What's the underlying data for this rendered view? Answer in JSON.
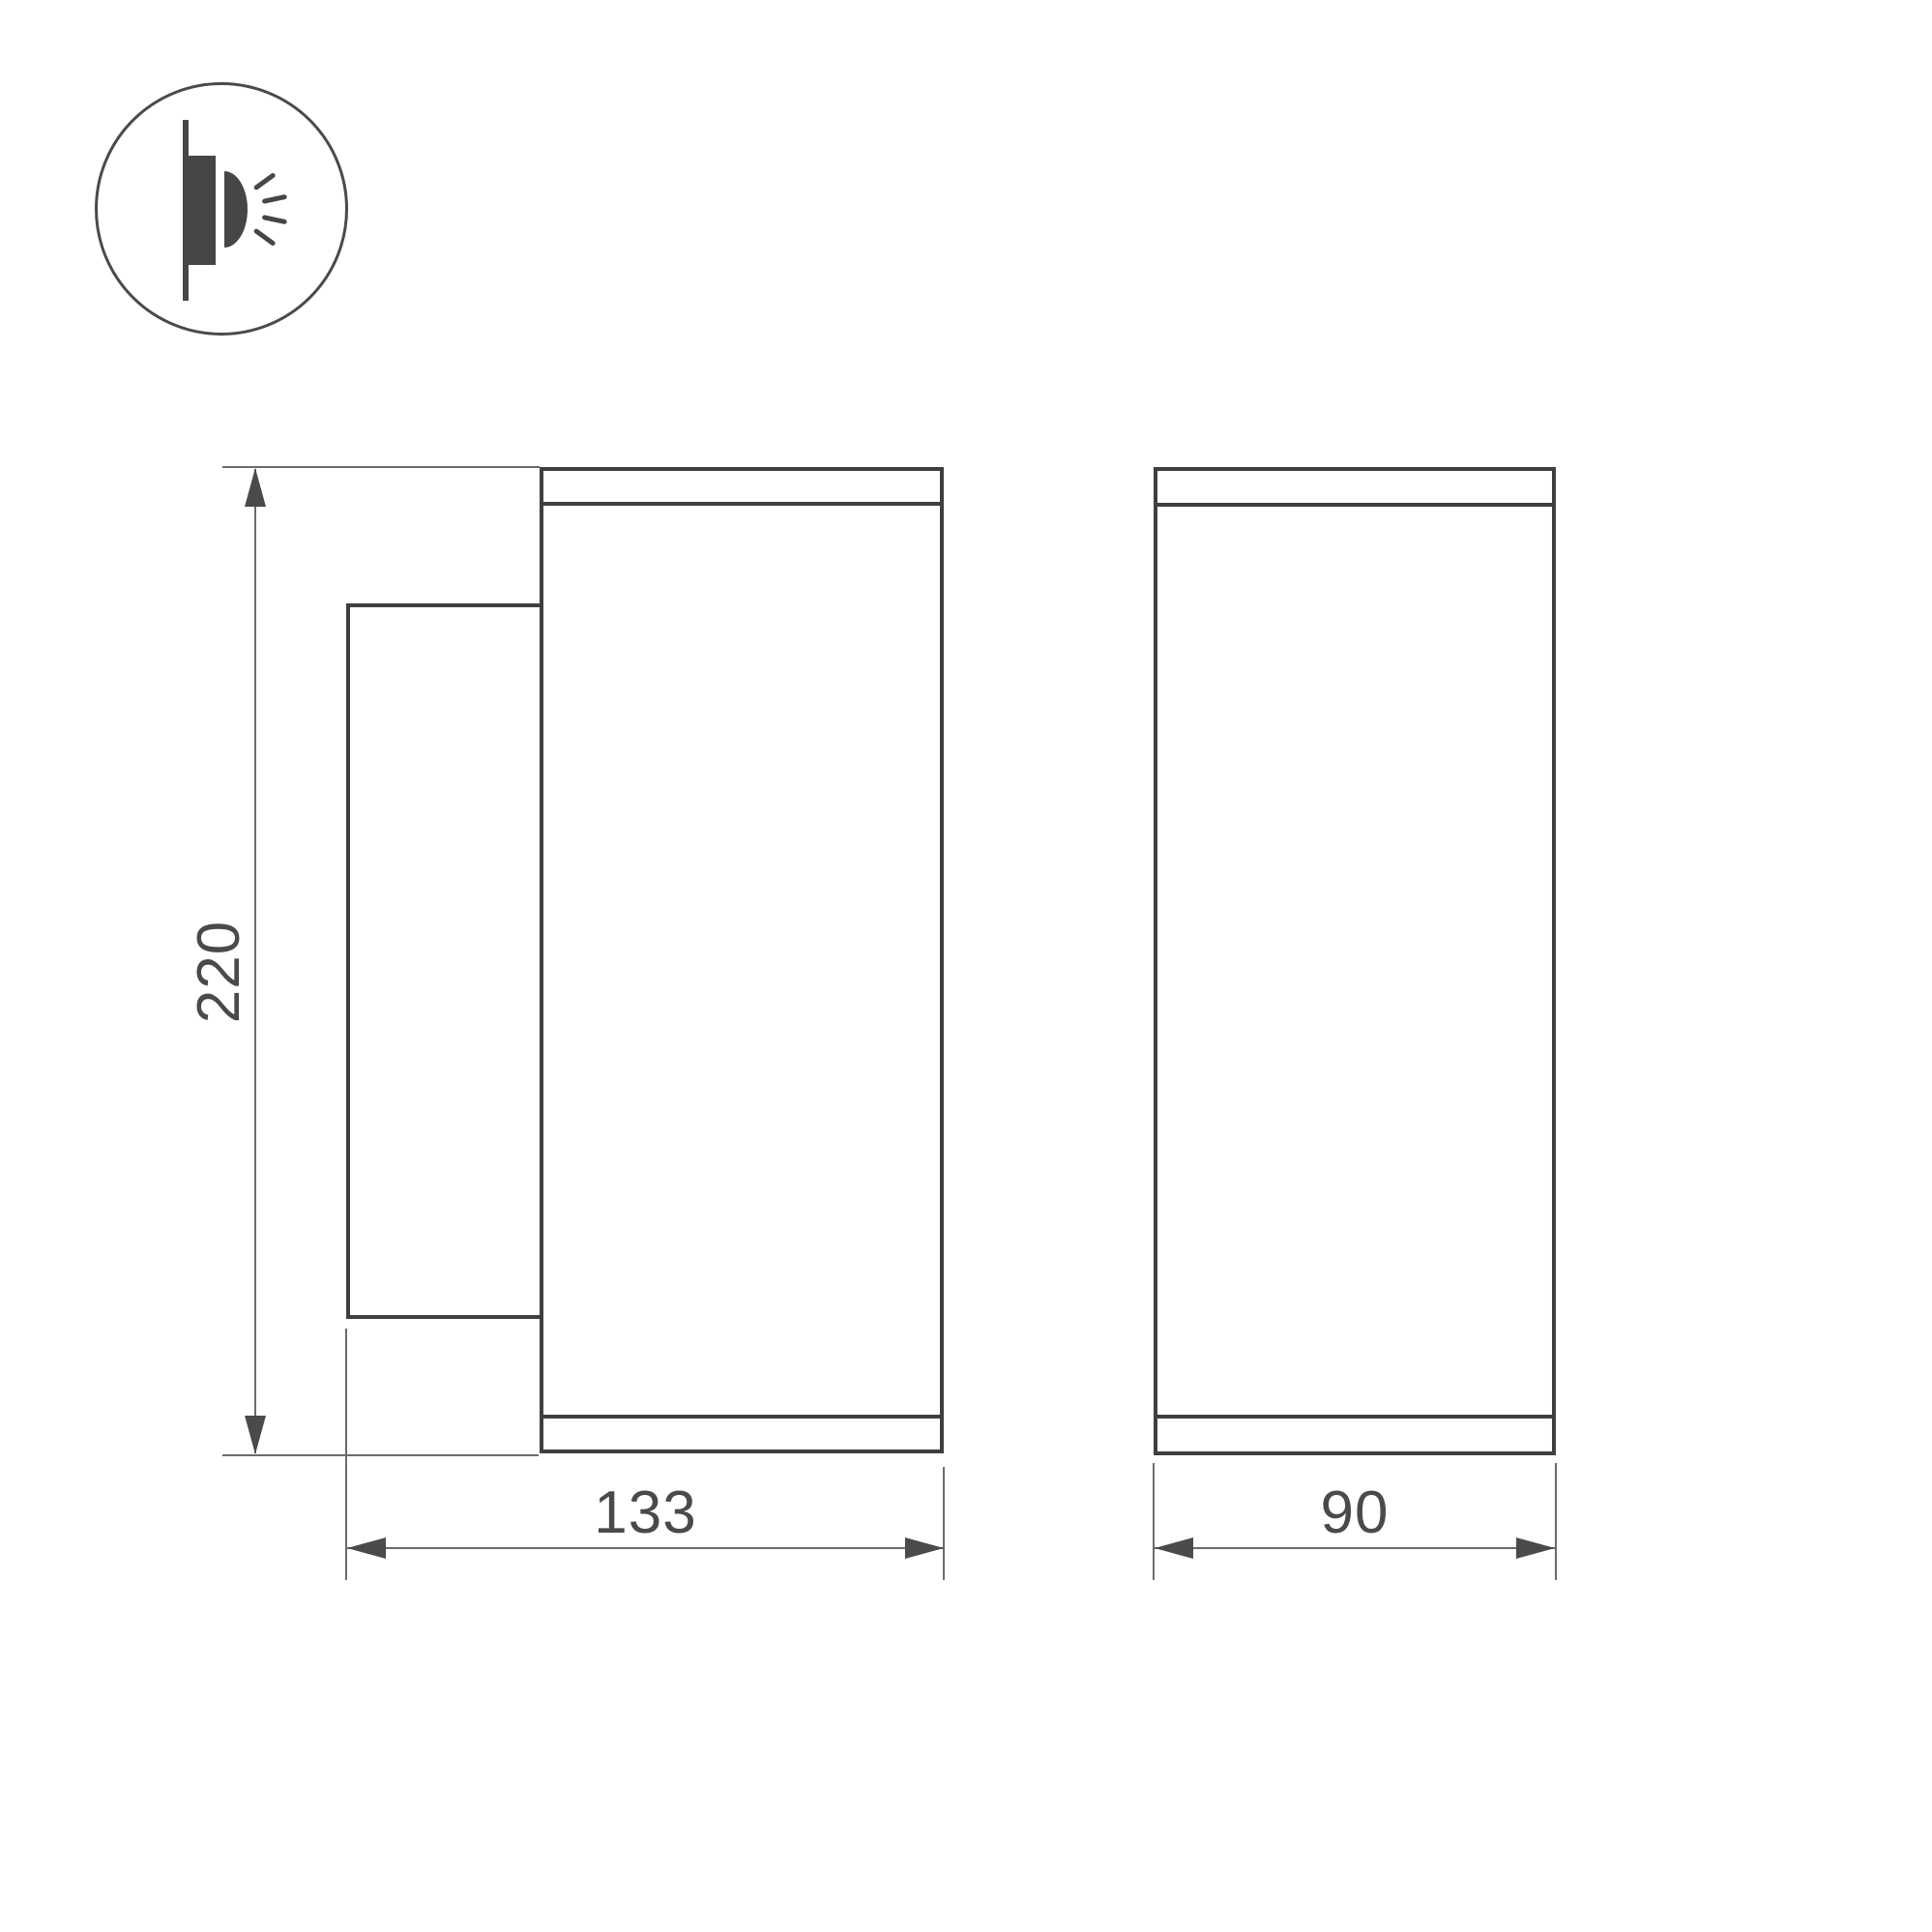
{
  "drawing": {
    "type": "technical-dimension-drawing",
    "dimension_labels": {
      "height": "220",
      "depth": "133",
      "width": "90"
    },
    "icons": {
      "mounting": "wall-mount-light-icon"
    },
    "colors": {
      "outline": "#3f3f3f",
      "dim_line": "#6b6b6b",
      "text": "#4a4a4a",
      "icon_fill": "#464646",
      "background": "#ffffff"
    }
  }
}
